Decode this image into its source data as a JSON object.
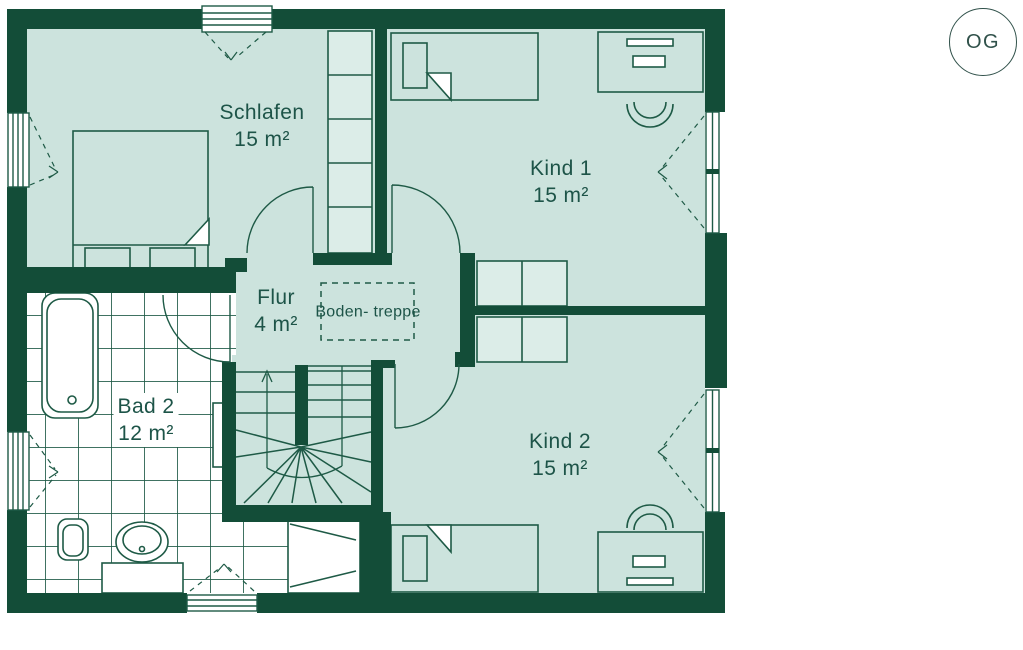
{
  "floor_badge": {
    "label": "OG"
  },
  "rooms": {
    "schlafen": {
      "name": "Schlafen",
      "area": "15 m²"
    },
    "kind1": {
      "name": "Kind 1",
      "area": "15 m²"
    },
    "kind2": {
      "name": "Kind 2",
      "area": "15 m²"
    },
    "bad2": {
      "name": "Bad 2",
      "area": "12 m²"
    },
    "flur": {
      "name": "Flur",
      "area": "4 m²"
    }
  },
  "features": {
    "attic_hatch_line1": "Boden-",
    "attic_hatch_line2": "treppe"
  },
  "colors": {
    "wall": "#134d38",
    "room_fill": "#cce3dd",
    "furniture_light": "#dcede8",
    "line": "#1e5a46",
    "text": "#1d5448",
    "tile_background": "#ffffff"
  }
}
